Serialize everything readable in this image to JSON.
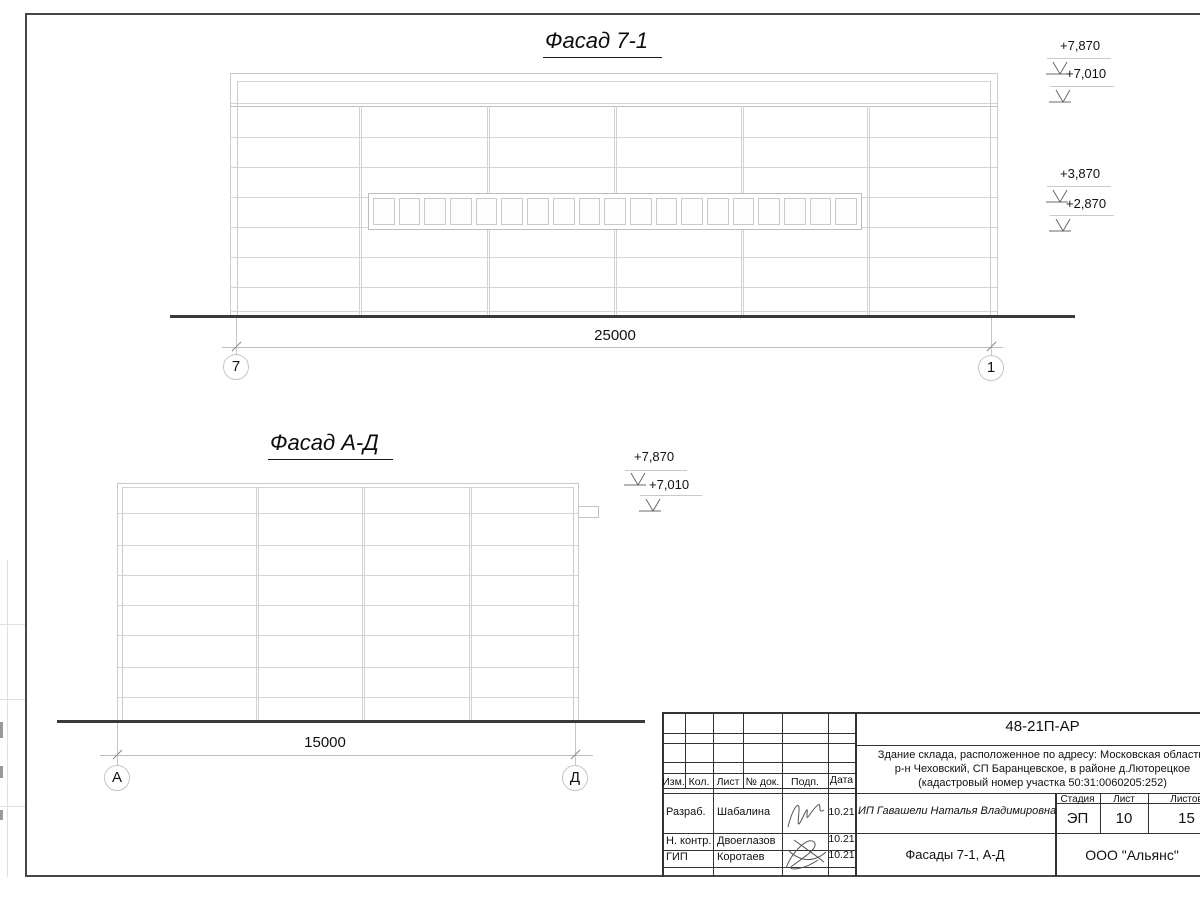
{
  "drawing": {
    "facade1": {
      "title": "Фасад 7-1",
      "dimension": "25000",
      "grid_left": "7",
      "grid_right": "1",
      "elev_7870": "+7,870",
      "elev_7010": "+7,010",
      "elev_3870": "+3,870",
      "elev_2870": "+2,870"
    },
    "facade2": {
      "title": "Фасад А-Д",
      "dimension": "15000",
      "grid_left": "А",
      "grid_right": "Д",
      "elev_7870": "+7,870",
      "elev_7010": "+7,010"
    }
  },
  "title_block": {
    "doc_number": "48-21П-АР",
    "address_line1": "Здание склада, расположенное по адресу: Московская область,",
    "address_line2": "р-н Чеховский, СП Баранцевское, в районе д.Люторецкое",
    "address_line3": "(кадастровый номер участка 50:31:0060205:252)",
    "cols": {
      "izm": "Изм.",
      "kol": "Кол.",
      "list": "Лист",
      "doc": "№ док.",
      "podp": "Подп.",
      "data": "Дата"
    },
    "row1": {
      "role": "Разраб.",
      "name": "Шабалина",
      "date": "10.21"
    },
    "row2": {
      "role": "Н. контр.",
      "name": "Двоеглазов",
      "date": "10.21"
    },
    "row3": {
      "role": "ГИП",
      "name": "Коротаев",
      "date": "10.21"
    },
    "client": "ИП Гавашели Наталья Владимировна",
    "stage_label": "Стадия",
    "sheet_label": "Лист",
    "sheets_label": "Листов",
    "stage_value": "ЭП",
    "sheet_value": "10",
    "sheets_value": "15",
    "sheet_title": "Фасады 7-1, А-Д",
    "company": "ООО \"Альянс\""
  }
}
